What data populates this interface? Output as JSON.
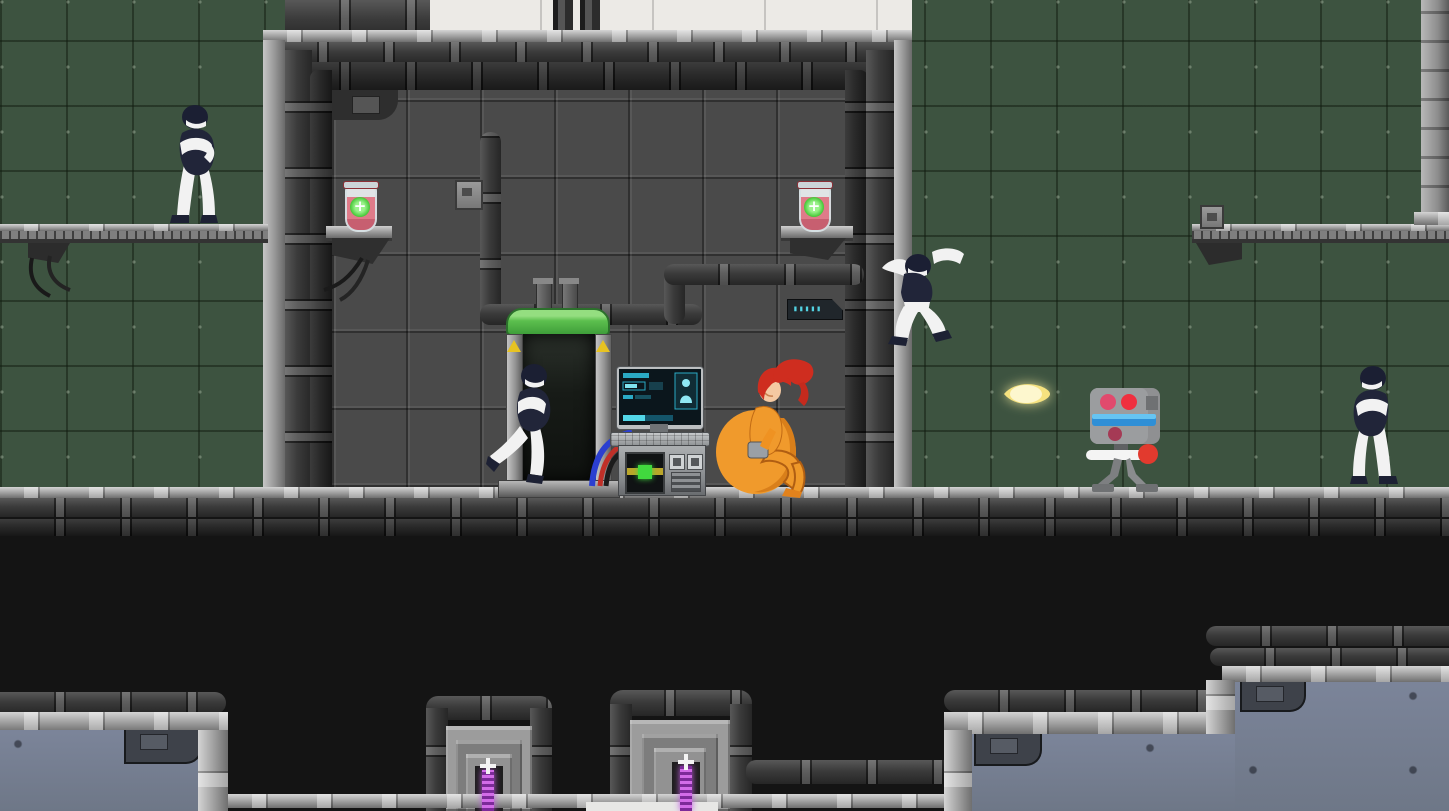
{
  "meta": {
    "scene_type": "2d side-scrolling sci-fi lab platformer",
    "viewport": "1449x811"
  },
  "palette": {
    "green_wall": "#3d5340",
    "green_seam": "#2c3a2a",
    "room_wall": "#4a4a4a",
    "white_panel": "#eceae6",
    "rail_light": "#9d9d9d",
    "pipe_dark": "#3b3b3b",
    "pipe_black": "#1d1d1d",
    "slate_wall": "#6e7787",
    "pit_black": "#141414",
    "pod_green": "#5cbf4e",
    "vial_pink": "#df7b89",
    "vial_cross_green": "#3fc431",
    "beam_purple": "#c05ce0",
    "fireball_yellow": "#f8edb2",
    "android_dark": "#212539",
    "android_white": "#f2f2f2",
    "player_orange": "#f09a2c",
    "player_hair_red": "#cf2d1f",
    "robot_gray": "#94969a",
    "robot_eye_red": "#e8365a",
    "robot_visor_blue": "#37a6ee",
    "gun_tip_red": "#e23a2e",
    "terminal_accent_cyan": "#3fc9dc",
    "warning_yellow": "#e7c322"
  },
  "sign": {
    "text": "▮▮▮▮▮",
    "color": "#52d2e2"
  },
  "pickups": {
    "health_vial_count": 2,
    "vial_symbol": "+"
  },
  "hazards": {
    "energy_beam_count": 2,
    "beam_color": "#c05ce0"
  },
  "machines": [
    {
      "name": "cloning-pod",
      "state": "open, android stepping out"
    },
    {
      "name": "lab-terminal",
      "state": "on, cyan diagnostics screen"
    },
    {
      "name": "sentry-robot",
      "state": "firing energy bolt left"
    }
  ],
  "characters": [
    {
      "name": "android-guard-left-platform",
      "pose": "standing, arms crossed"
    },
    {
      "name": "android-exiting-pod",
      "pose": "walking left"
    },
    {
      "name": "android-leaping",
      "pose": "mid-air jump"
    },
    {
      "name": "android-guard-right",
      "pose": "standing, facing left"
    },
    {
      "name": "player-orange-suit",
      "pose": "sitting, inflated suit, red ponytail"
    }
  ],
  "projectile": {
    "type": "energy-bolt",
    "direction": "left",
    "color": "#f8edb2"
  }
}
